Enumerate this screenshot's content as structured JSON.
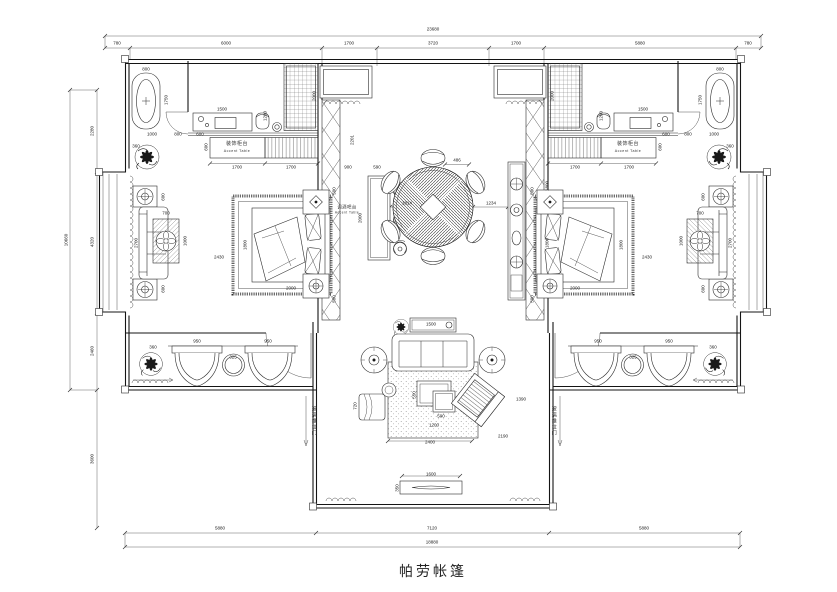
{
  "page": {
    "background": "#ffffff",
    "line_color": "#2b2b2b"
  },
  "title_block": {
    "title": "帕劳帐篷"
  },
  "dimension_labels": [
    {
      "t": "23680",
      "x": 433,
      "y": 29
    },
    {
      "t": "780",
      "x": 117,
      "y": 43
    },
    {
      "t": "6000",
      "x": 226,
      "y": 43
    },
    {
      "t": "1700",
      "x": 349,
      "y": 43
    },
    {
      "t": "3720",
      "x": 433,
      "y": 43
    },
    {
      "t": "1700",
      "x": 516,
      "y": 43
    },
    {
      "t": "5880",
      "x": 640,
      "y": 43
    },
    {
      "t": "780",
      "x": 748,
      "y": 43
    },
    {
      "t": "10660",
      "x": 66,
      "y": 240,
      "r": 1
    },
    {
      "t": "2280",
      "x": 92,
      "y": 131,
      "r": 1
    },
    {
      "t": "4320",
      "x": 92,
      "y": 242,
      "r": 1
    },
    {
      "t": "2460",
      "x": 92,
      "y": 351,
      "r": 1
    },
    {
      "t": "3600",
      "x": 92,
      "y": 459,
      "r": 1
    },
    {
      "t": "5880",
      "x": 220,
      "y": 528
    },
    {
      "t": "7120",
      "x": 432,
      "y": 528
    },
    {
      "t": "5880",
      "x": 644,
      "y": 528
    },
    {
      "t": "18880",
      "x": 432,
      "y": 542
    },
    {
      "t": "800",
      "x": 146,
      "y": 69
    },
    {
      "t": "1750",
      "x": 166,
      "y": 100,
      "r": 1
    },
    {
      "t": "1000",
      "x": 152,
      "y": 134
    },
    {
      "t": "800",
      "x": 178,
      "y": 134
    },
    {
      "t": "600",
      "x": 200,
      "y": 134
    },
    {
      "t": "1500",
      "x": 222,
      "y": 109
    },
    {
      "t": "1200",
      "x": 265,
      "y": 116,
      "r": 1
    },
    {
      "t": "2000",
      "x": 314,
      "y": 96,
      "r": 1
    },
    {
      "t": "600",
      "x": 206,
      "y": 147,
      "r": 1
    },
    {
      "t": "1700",
      "x": 237,
      "y": 167
    },
    {
      "t": "1700",
      "x": 291,
      "y": 167
    },
    {
      "t": "360",
      "x": 136,
      "y": 146
    },
    {
      "t": "600",
      "x": 163,
      "y": 197,
      "r": 1
    },
    {
      "t": "2700",
      "x": 136,
      "y": 243,
      "r": 1
    },
    {
      "t": "600",
      "x": 163,
      "y": 289,
      "r": 1
    },
    {
      "t": "700",
      "x": 166,
      "y": 213
    },
    {
      "t": "1000",
      "x": 185,
      "y": 241,
      "r": 1
    },
    {
      "t": "2430",
      "x": 219,
      "y": 257
    },
    {
      "t": "1800",
      "x": 245,
      "y": 245,
      "r": 1
    },
    {
      "t": "2000",
      "x": 291,
      "y": 288
    },
    {
      "t": "500",
      "x": 334,
      "y": 191,
      "r": 1
    },
    {
      "t": "500",
      "x": 334,
      "y": 299,
      "r": 1
    },
    {
      "t": "950",
      "x": 197,
      "y": 341
    },
    {
      "t": "950",
      "x": 268,
      "y": 341
    },
    {
      "t": "325",
      "x": 233,
      "y": 357
    },
    {
      "t": "360",
      "x": 153,
      "y": 347
    },
    {
      "t": "2201",
      "x": 352,
      "y": 140,
      "r": 1
    },
    {
      "t": "900",
      "x": 348,
      "y": 167
    },
    {
      "t": "590",
      "x": 377,
      "y": 167
    },
    {
      "t": "2000",
      "x": 360,
      "y": 218,
      "r": 1
    },
    {
      "t": "1814",
      "x": 407,
      "y": 203
    },
    {
      "t": "486",
      "x": 457,
      "y": 160
    },
    {
      "t": "1234",
      "x": 491,
      "y": 203
    },
    {
      "t": "1800",
      "x": 547,
      "y": 186,
      "r": 1
    },
    {
      "t": "1800",
      "x": 547,
      "y": 243,
      "r": 1
    },
    {
      "t": "1500",
      "x": 431,
      "y": 324
    },
    {
      "t": "550",
      "x": 414,
      "y": 395,
      "r": 1
    },
    {
      "t": "500",
      "x": 441,
      "y": 416
    },
    {
      "t": "1200",
      "x": 434,
      "y": 425
    },
    {
      "t": "2400",
      "x": 430,
      "y": 442
    },
    {
      "t": "2190",
      "x": 503,
      "y": 436
    },
    {
      "t": "1390",
      "x": 521,
      "y": 399
    },
    {
      "t": "720",
      "x": 355,
      "y": 406,
      "r": 1
    },
    {
      "t": "1600",
      "x": 431,
      "y": 474
    },
    {
      "t": "350",
      "x": 397,
      "y": 488,
      "r": 1
    },
    {
      "t": "800",
      "x": 720,
      "y": 69
    },
    {
      "t": "1750",
      "x": 700,
      "y": 100,
      "r": 1
    },
    {
      "t": "1000",
      "x": 714,
      "y": 134
    },
    {
      "t": "800",
      "x": 688,
      "y": 134
    },
    {
      "t": "600",
      "x": 666,
      "y": 134
    },
    {
      "t": "1500",
      "x": 643,
      "y": 109
    },
    {
      "t": "1200",
      "x": 601,
      "y": 116,
      "r": 1
    },
    {
      "t": "2000",
      "x": 552,
      "y": 96,
      "r": 1
    },
    {
      "t": "600",
      "x": 660,
      "y": 147,
      "r": 1
    },
    {
      "t": "1700",
      "x": 575,
      "y": 167
    },
    {
      "t": "1700",
      "x": 629,
      "y": 167
    },
    {
      "t": "360",
      "x": 730,
      "y": 146
    },
    {
      "t": "600",
      "x": 703,
      "y": 197,
      "r": 1
    },
    {
      "t": "2700",
      "x": 730,
      "y": 243,
      "r": 1
    },
    {
      "t": "600",
      "x": 703,
      "y": 289,
      "r": 1
    },
    {
      "t": "700",
      "x": 700,
      "y": 213
    },
    {
      "t": "1000",
      "x": 681,
      "y": 241,
      "r": 1
    },
    {
      "t": "2430",
      "x": 647,
      "y": 257
    },
    {
      "t": "1800",
      "x": 621,
      "y": 245,
      "r": 1
    },
    {
      "t": "2000",
      "x": 575,
      "y": 288
    },
    {
      "t": "500",
      "x": 532,
      "y": 191,
      "r": 1
    },
    {
      "t": "500",
      "x": 532,
      "y": 299,
      "r": 1
    },
    {
      "t": "950",
      "x": 598,
      "y": 341
    },
    {
      "t": "950",
      "x": 669,
      "y": 341
    },
    {
      "t": "325",
      "x": 633,
      "y": 357
    },
    {
      "t": "360",
      "x": 713,
      "y": 347
    }
  ],
  "text_labels": [
    {
      "t": "装饰柜台",
      "x": 237,
      "y": 144,
      "s": 5
    },
    {
      "t": "Accent Table",
      "x": 237,
      "y": 151,
      "s": 3.6
    },
    {
      "t": "装饰柜台",
      "x": 628,
      "y": 144,
      "s": 5
    },
    {
      "t": "Accent Table",
      "x": 628,
      "y": 151,
      "s": 3.6
    },
    {
      "t": "调酒吧台",
      "x": 347,
      "y": 207,
      "s": 4.4
    },
    {
      "t": "Accent Table",
      "x": 347,
      "y": 213,
      "s": 3.2
    },
    {
      "t": "玻璃推拉门",
      "x": 313,
      "y": 421,
      "s": 5,
      "v": 1
    },
    {
      "t": "玻璃推拉门",
      "x": 553,
      "y": 421,
      "s": 5,
      "v": 1
    }
  ]
}
